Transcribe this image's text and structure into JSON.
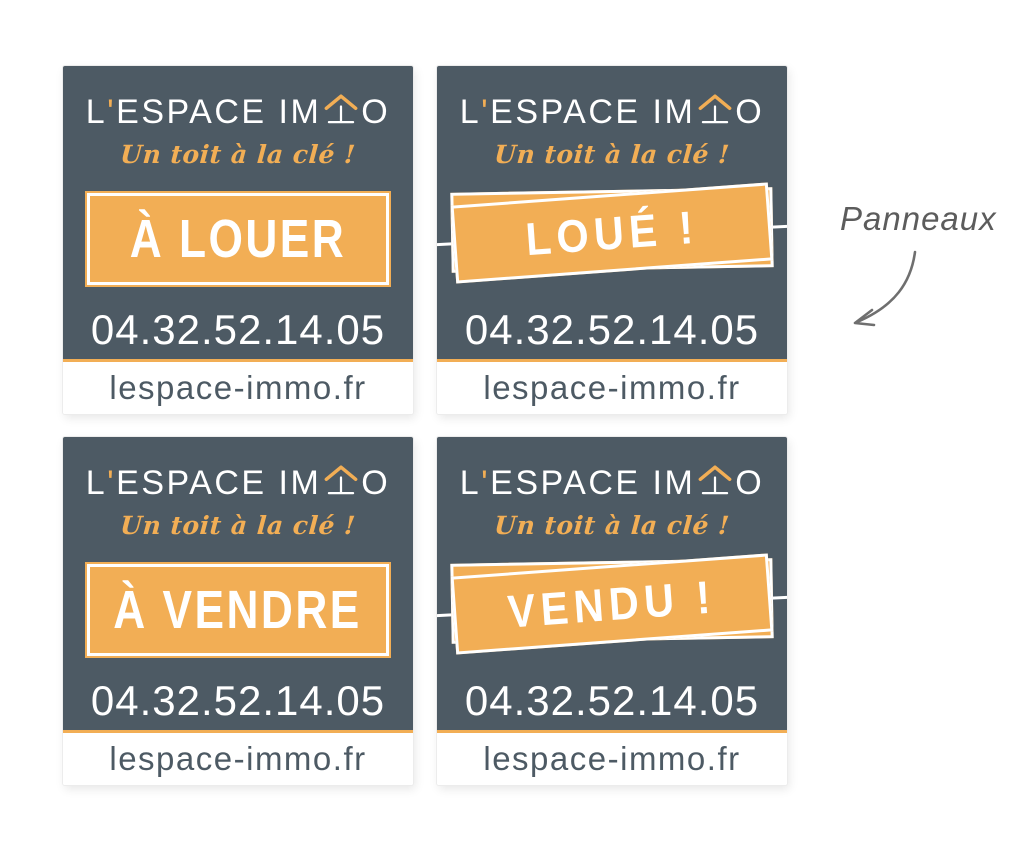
{
  "colors": {
    "slate": "#4d5a64",
    "orange": "#f2ae55",
    "white": "#ffffff",
    "annotation_gray": "#6f6f6f",
    "page_background": "#ffffff"
  },
  "brand": {
    "logo_l": "L",
    "logo_apostrophe": "'",
    "logo_mid": "ESPACE IM",
    "logo_end": "O",
    "tagline": "Un toit à la clé !",
    "phone": "04.32.52.14.05",
    "website": "lespace-immo.fr"
  },
  "signs": [
    {
      "id": "a-louer",
      "status_label": "À LOUER",
      "banner_style": "straight"
    },
    {
      "id": "loue",
      "status_label": "LOUÉ !",
      "banner_style": "tilted"
    },
    {
      "id": "a-vendre",
      "status_label": "À VENDRE",
      "banner_style": "straight"
    },
    {
      "id": "vendu",
      "status_label": "VENDU !",
      "banner_style": "tilted"
    }
  ],
  "annotation": {
    "label": "Panneaux"
  }
}
